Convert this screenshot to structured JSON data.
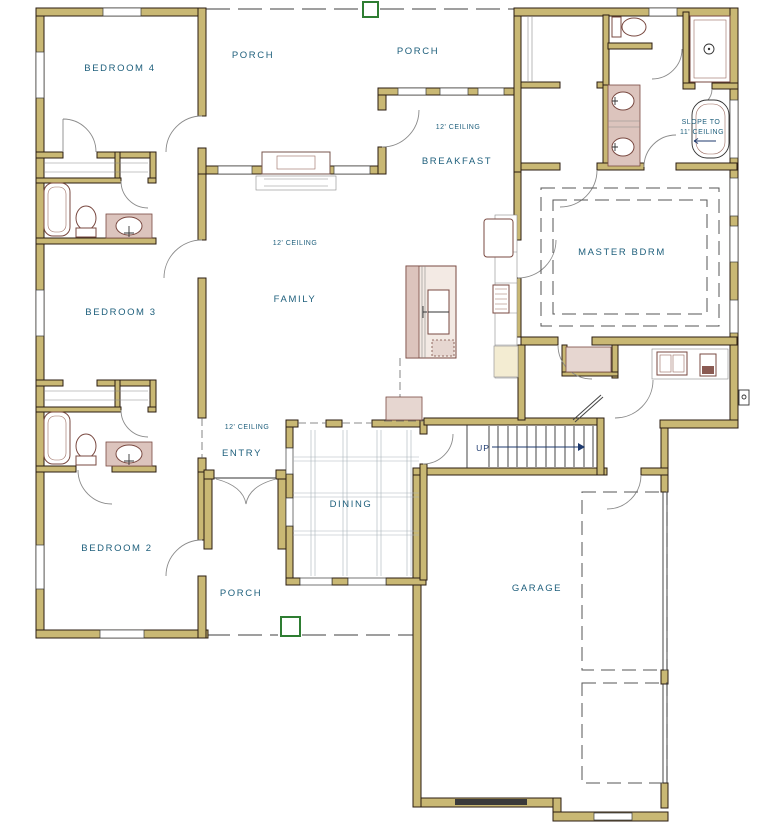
{
  "plan_type": "first-floor-plan",
  "rooms": {
    "bedroom4": "BEDROOM 4",
    "bedroom3": "BEDROOM 3",
    "bedroom2": "BEDROOM 2",
    "master": "MASTER BDRM",
    "family": "FAMILY",
    "breakfast": "BREAKFAST",
    "dining": "DINING",
    "entry": "ENTRY",
    "garage": "GARAGE",
    "porch_top_left": "PORCH",
    "porch_top_right": "PORCH",
    "porch_bottom": "PORCH"
  },
  "annotations": {
    "ceiling_family": "12' CEILING",
    "ceiling_breakfast": "12' CEILING",
    "ceiling_entry": "12' CEILING",
    "slope_1": "SLOPE TO",
    "slope_2": "11' CEILING",
    "stairs_up": "UP"
  },
  "fixtures": [
    "bathtub-icon",
    "toilet-icon",
    "vanity-sink-icon",
    "shower-icon",
    "soaking-tub-icon",
    "double-vanity-icon",
    "kitchen-island-sink-icon",
    "range-icon",
    "refrigerator-icon",
    "pantry-cabinet-icon",
    "fireplace-icon",
    "laundry-sink-counter-icon",
    "stairs-up-icon",
    "garage-door-track-icon",
    "porch-post-icon",
    "electrical-panel-icon",
    "entry-double-door-icon",
    "closet-shelf-icon"
  ],
  "colors": {
    "wall_fill": "#C9B874",
    "wall_outline": "#2B1D12",
    "label_text": "#1E5F7C",
    "fixture_stroke": "#7A4A42",
    "fixture_shade": "#DCC4BD",
    "porch_post_green": "#2E7D32",
    "stairs_arrow_navy": "#1E3A6E",
    "background": "#FFFFFF"
  }
}
